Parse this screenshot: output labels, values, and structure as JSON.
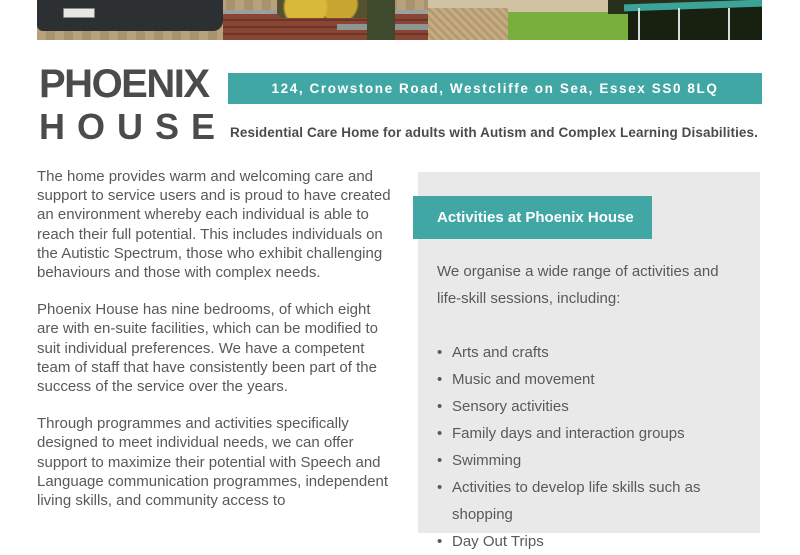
{
  "colors": {
    "teal": "#41a7a4",
    "logo_gray": "#4b4b4d",
    "body_gray": "#59595b",
    "panel_bg": "#e9e9e9"
  },
  "photos": {
    "left_alt": "driveway with parked car, brick walls and yellow flowers",
    "right_alt": "garden with gravel path, artificial lawn and trampoline"
  },
  "header": {
    "logo_line1": "PHOENIX",
    "logo_line2": "HOUSE",
    "address": "124, Crowstone Road, Westcliffe on Sea, Essex SS0 8LQ",
    "tagline": "Residential Care Home for adults with Autism and Complex Learning Disabilities."
  },
  "main": {
    "paragraphs": [
      "The home provides warm and welcoming care and support to service users and is proud to have created an environment whereby each individual is able to reach their full potential. This includes individuals on the Autistic Spectrum, those who exhibit challenging behaviours and those with complex needs.",
      "Phoenix House has nine bedrooms, of which eight are with en-suite facilities, which can be modified to suit individual preferences. We have a competent team of staff that have consistently been part of the success of the service over the years.",
      "Through programmes and activities specifically designed to meet individual needs, we can offer support to maximize their potential with Speech and Language communication programmes, independent living skills, and community access to"
    ]
  },
  "activities_panel": {
    "title": "Activities at Phoenix House",
    "intro": "We organise a wide range of activities and life-skill sessions, including:",
    "items": [
      "Arts and crafts",
      "Music and movement",
      "Sensory activities",
      "Family days and interaction groups",
      "Swimming",
      "Activities to develop life skills such as shopping",
      "Day Out Trips"
    ]
  }
}
